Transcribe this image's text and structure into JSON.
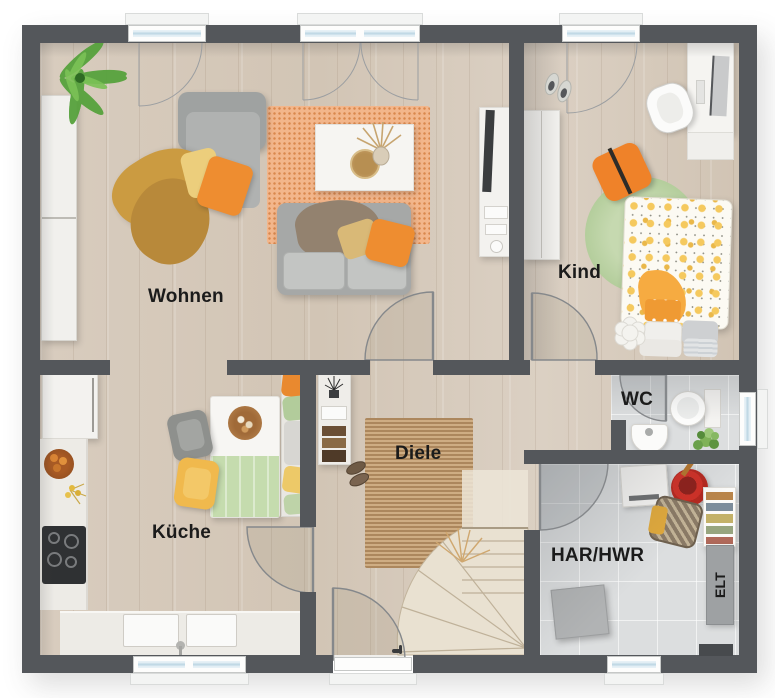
{
  "plan": {
    "rooms": [
      {
        "id": "wohnen",
        "label": "Wohnen"
      },
      {
        "id": "kind",
        "label": "Kind"
      },
      {
        "id": "kueche",
        "label": "Küche"
      },
      {
        "id": "diele",
        "label": "Diele"
      },
      {
        "id": "wc",
        "label": "WC"
      },
      {
        "id": "har-hwr",
        "label": "HAR/HWR"
      },
      {
        "id": "elt",
        "label": "ELT"
      }
    ],
    "colors": {
      "wall": "#54575b",
      "floor_wood": "#d6cabb",
      "floor_tile": "#dcdedf",
      "rug_living_orange": "#f3b68b",
      "rug_hall_brown": "#c09a6e",
      "rug_kid_green": "#b3cd9b",
      "accent_orange": "#ee8d30",
      "accent_yellow": "#ecce7c",
      "window_glass": "#bcd6e3"
    }
  }
}
